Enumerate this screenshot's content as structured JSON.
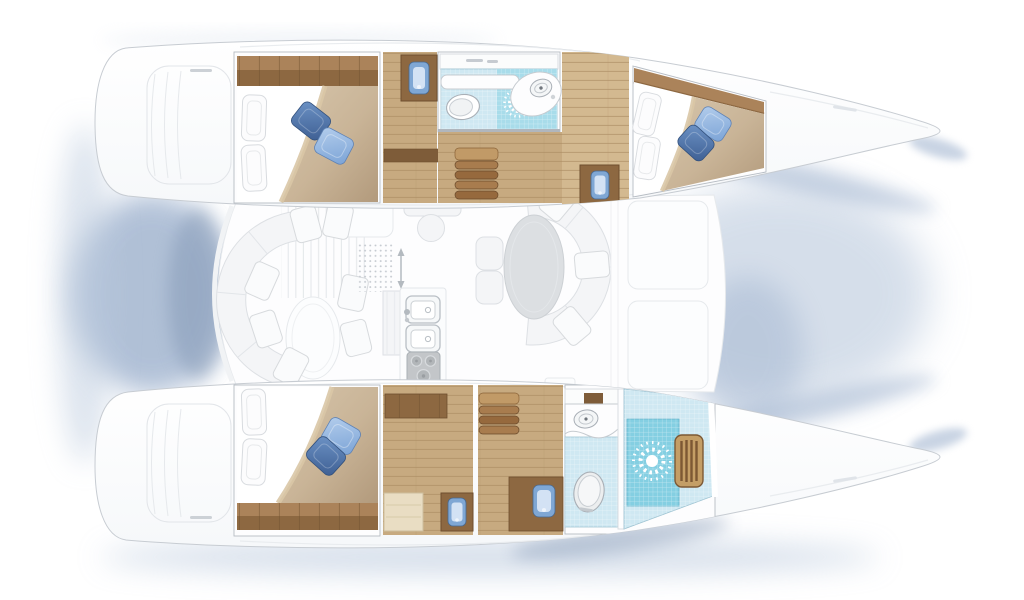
{
  "palette": {
    "hull_stroke": "#c7ccd2",
    "wall_stroke": "#b6bcc3",
    "wood_hi": "#ab835a",
    "wood_dark": "#8d6841",
    "wood_mid": "#7e5c39",
    "wood_edge": "#6e4e2e",
    "wood_floor": "#c7aa80",
    "wood_floor_light": "#d3b990",
    "wood_line": "#a8895f",
    "step_light": "#c19a67",
    "step_mid": "#a87c4e",
    "step_dark": "#96693d",
    "bed_light": "#d6c5ab",
    "bed_mid": "#c9b497",
    "bed_deep": "#b29a7c",
    "bed_accent": "#d9c6a6",
    "sheet_white": "#ffffff",
    "tile_light": "#cfe8f2",
    "tile_mid": "#a8dcea",
    "shower_blue": "#84cfe2",
    "tile_edge": "#9ec3d2",
    "teak": "#c49e66",
    "teak_slat": "#7c5834",
    "sink_blue": "#7fa7d4",
    "sink_blue_light": "#d3e2f4",
    "fixture_stroke": "#a9afb6",
    "table_gray": "#dcdfe2",
    "stove_gray": "#c3c6c9",
    "pillow_dark_1": "#3d5e92",
    "pillow_dark_2": "#6d93c6",
    "pillow_light_1": "#7ba3d6",
    "pillow_light_2": "#b3cdec",
    "shadow_soft": "#bac9dd",
    "shadow_mid": "#9db1cd",
    "shadow_deep": "#8196b4"
  },
  "vessel": {
    "type": "catamaran sailing yacht",
    "view": "interior layout floor plan, top-down",
    "cabins_count": 3,
    "heads_count": 2,
    "double_berths": 3,
    "hulls": [
      {
        "side": "port (top)",
        "rooms": [
          "aft double cabin with headboard, two white pillows, two blue cushions",
          "hallway with vanity washbasin",
          "head with toilet, washbasin counter and tiled shower",
          "companionway steps",
          "forward double cabin with angled berth"
        ]
      },
      {
        "side": "starboard (bottom)",
        "rooms": [
          "aft double cabin with footboard, two white pillows, two blue cushions",
          "dressing area with bench and vanity washbasin",
          "companionway steps and hallway with vanity washbasin",
          "head with washbasin counter and toilet",
          "shower room with teak grating"
        ]
      }
    ],
    "bridgedeck": {
      "areas": [
        "aft cockpit with curved bench, scattered cushions and oval table",
        "salon with oval dining table and wraparound sofa",
        "chart table with stool",
        "galley with double sink and three-burner stove",
        "foredeck panels between bows"
      ]
    }
  }
}
